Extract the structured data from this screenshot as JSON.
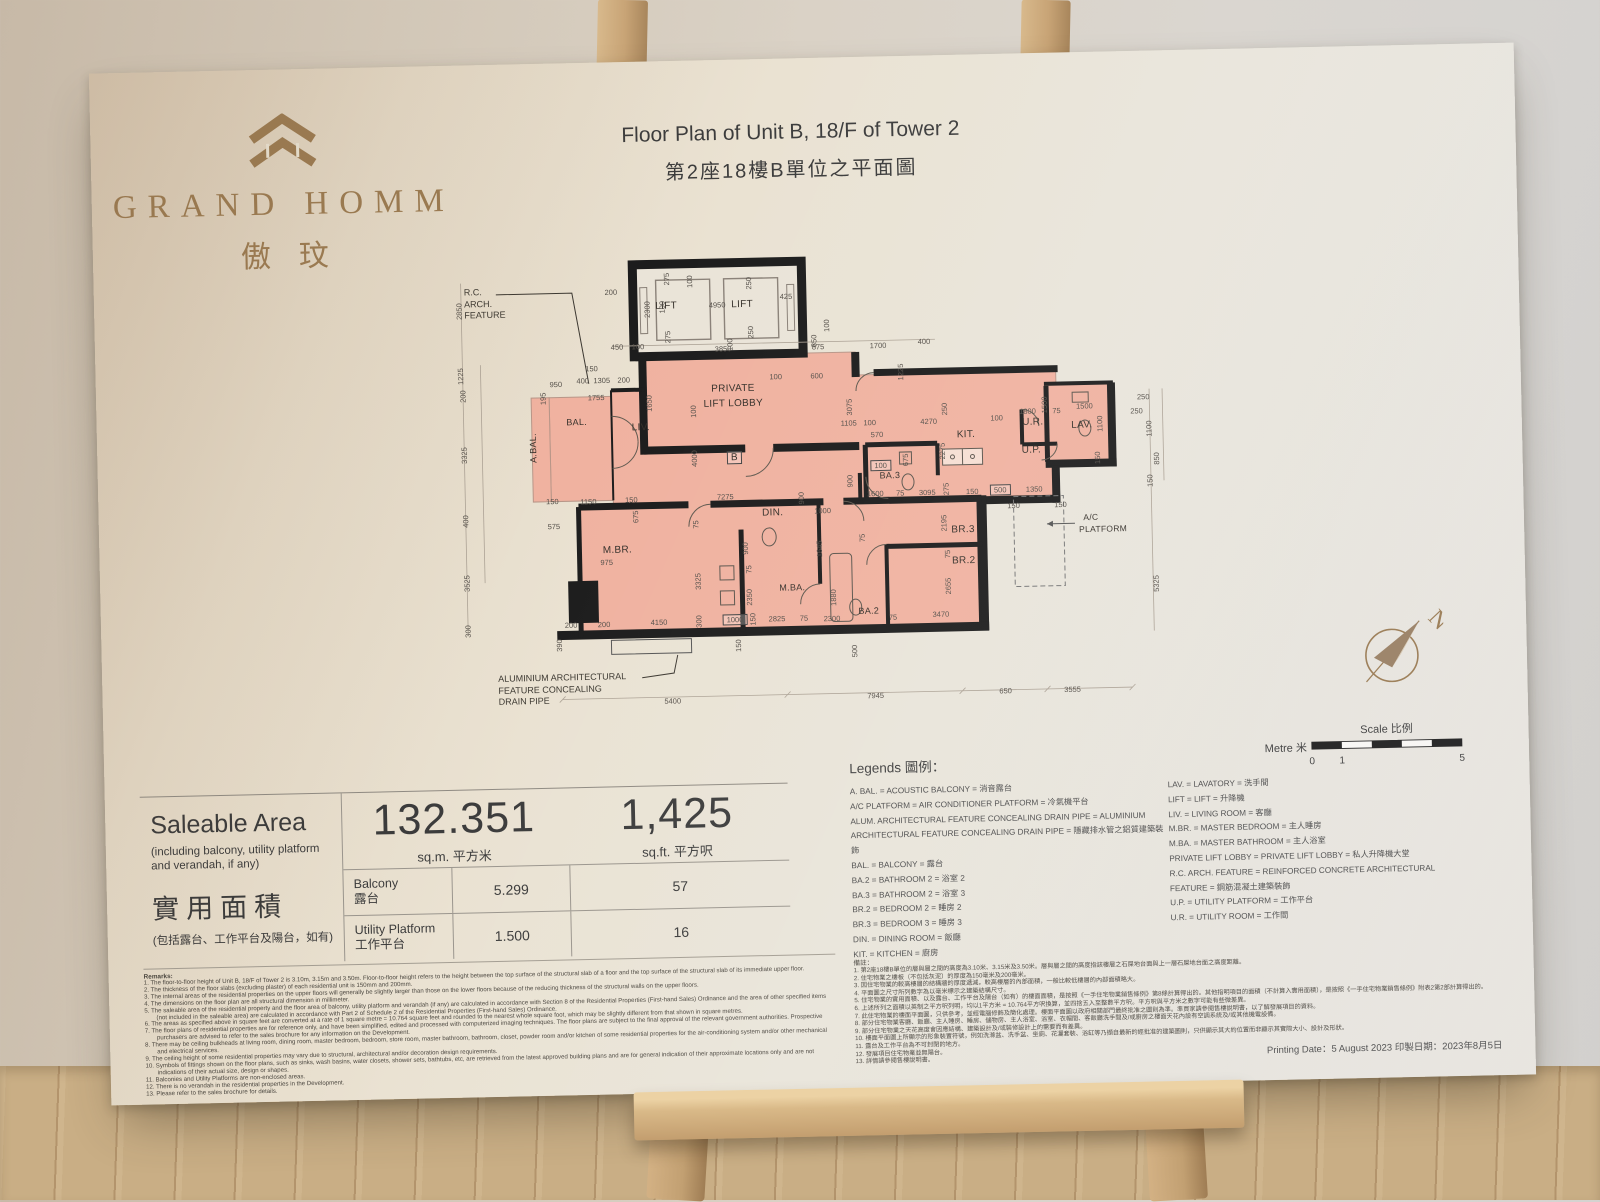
{
  "logo": {
    "name": "GRAND HOMM",
    "chinese": "傲玟",
    "brand_color": "#9b7b52"
  },
  "title": {
    "en": "Floor Plan of Unit B, 18/F of Tower 2",
    "zh": "第2座18樓B單位之平面圖"
  },
  "plan": {
    "fill_color": "#f0b2a0",
    "unit_marker": "B",
    "north_label": "N",
    "rc_feature": [
      "R.C.",
      "ARCH.",
      "FEATURE"
    ],
    "alum_feature": [
      "ALUMINIUM  ARCHITECTURAL",
      "FEATURE  CONCEALING",
      "DRAIN  PIPE"
    ],
    "rooms": [
      {
        "t": "LIFT",
        "x": 232,
        "y": 57
      },
      {
        "t": "LIFT",
        "x": 308,
        "y": 57
      },
      {
        "t": "PRIVATE",
        "x": 297,
        "y": 141
      },
      {
        "t": "LIFT LOBBY",
        "x": 297,
        "y": 156
      },
      {
        "t": "BAL.",
        "x": 140,
        "y": 171,
        "s": 9
      },
      {
        "t": "A.BAL.",
        "x": 96,
        "y": 196,
        "v": 1,
        "s": 9
      },
      {
        "t": "LIV.",
        "x": 204,
        "y": 178
      },
      {
        "t": "B",
        "x": 297,
        "y": 210,
        "box": 1
      },
      {
        "t": "DIN.",
        "x": 334,
        "y": 266
      },
      {
        "t": "KIT.",
        "x": 529,
        "y": 192
      },
      {
        "t": "U.R.",
        "x": 596,
        "y": 181
      },
      {
        "t": "U.P.",
        "x": 594,
        "y": 209
      },
      {
        "t": "LAV.",
        "x": 645,
        "y": 185
      },
      {
        "t": "BA.3",
        "x": 452,
        "y": 231,
        "s": 9
      },
      {
        "t": "M.BR.",
        "x": 178,
        "y": 300
      },
      {
        "t": "M.BA.",
        "x": 352,
        "y": 341,
        "s": 9
      },
      {
        "t": "BA.2",
        "x": 428,
        "y": 366,
        "s": 9
      },
      {
        "t": "BR.3",
        "x": 524,
        "y": 287
      },
      {
        "t": "BR.2",
        "x": 524,
        "y": 318
      },
      {
        "t": "A/C",
        "x": 652,
        "y": 277,
        "s": 8.5
      },
      {
        "t": "PLATFORM",
        "x": 664,
        "y": 289,
        "s": 8.5
      }
    ],
    "dims": [
      {
        "t": "200",
        "x": 177,
        "y": 42
      },
      {
        "t": "2300",
        "x": 213,
        "y": 60,
        "v": 1
      },
      {
        "t": "100",
        "x": 228,
        "y": 58,
        "v": 1
      },
      {
        "t": "4950",
        "x": 283,
        "y": 57
      },
      {
        "t": "425",
        "x": 352,
        "y": 50
      },
      {
        "t": "275",
        "x": 233,
        "y": 30,
        "v": 1
      },
      {
        "t": "100",
        "x": 256,
        "y": 33,
        "v": 1
      },
      {
        "t": "250",
        "x": 315,
        "y": 36,
        "v": 1
      },
      {
        "t": "275",
        "x": 233,
        "y": 88,
        "v": 1
      },
      {
        "t": "250",
        "x": 316,
        "y": 85,
        "v": 1
      },
      {
        "t": "100",
        "x": 295,
        "y": 97,
        "v": 1
      },
      {
        "t": "450",
        "x": 182,
        "y": 97
      },
      {
        "t": "100",
        "x": 203,
        "y": 97
      },
      {
        "t": "3850",
        "x": 288,
        "y": 101
      },
      {
        "t": "875",
        "x": 383,
        "y": 101
      },
      {
        "t": "1700",
        "x": 443,
        "y": 101
      },
      {
        "t": "400",
        "x": 489,
        "y": 98
      },
      {
        "t": "150",
        "x": 156,
        "y": 118
      },
      {
        "t": "950",
        "x": 120,
        "y": 133
      },
      {
        "t": "400",
        "x": 147,
        "y": 130
      },
      {
        "t": "1305",
        "x": 166,
        "y": 130
      },
      {
        "t": "200",
        "x": 188,
        "y": 130
      },
      {
        "t": "1650",
        "x": 213,
        "y": 154,
        "v": 1
      },
      {
        "t": "1755",
        "x": 160,
        "y": 147
      },
      {
        "t": "100",
        "x": 257,
        "y": 163,
        "v": 1
      },
      {
        "t": "850",
        "x": 379,
        "y": 95,
        "v": 1
      },
      {
        "t": "100",
        "x": 392,
        "y": 80,
        "v": 1
      },
      {
        "t": "1225",
        "x": 465,
        "y": 128,
        "v": 1
      },
      {
        "t": "100",
        "x": 340,
        "y": 130
      },
      {
        "t": "600",
        "x": 381,
        "y": 130
      },
      {
        "t": "3075",
        "x": 413,
        "y": 162,
        "v": 1
      },
      {
        "t": "1105",
        "x": 412,
        "y": 178
      },
      {
        "t": "100",
        "x": 433,
        "y": 178
      },
      {
        "t": "570",
        "x": 440,
        "y": 190
      },
      {
        "t": "4270",
        "x": 492,
        "y": 178
      },
      {
        "t": "250",
        "x": 508,
        "y": 166,
        "v": 1
      },
      {
        "t": "2275",
        "x": 505,
        "y": 208,
        "v": 1
      },
      {
        "t": "675",
        "x": 468,
        "y": 216,
        "v": 1
      },
      {
        "t": "100",
        "x": 560,
        "y": 176
      },
      {
        "t": "1800",
        "x": 591,
        "y": 170
      },
      {
        "t": "1500",
        "x": 608,
        "y": 164,
        "v": 1
      },
      {
        "t": "75",
        "x": 620,
        "y": 170
      },
      {
        "t": "1500",
        "x": 648,
        "y": 166
      },
      {
        "t": "1100",
        "x": 663,
        "y": 184,
        "v": 1
      },
      {
        "t": "250",
        "x": 700,
        "y": 172
      },
      {
        "t": "1100",
        "x": 712,
        "y": 190,
        "v": 1
      },
      {
        "t": "150",
        "x": 660,
        "y": 218,
        "v": 1
      },
      {
        "t": "850",
        "x": 719,
        "y": 220,
        "v": 1
      },
      {
        "t": "150",
        "x": 712,
        "y": 242,
        "v": 1
      },
      {
        "t": "5325",
        "x": 716,
        "y": 345,
        "v": 1
      },
      {
        "t": "100",
        "x": 443,
        "y": 221,
        "box": 1
      },
      {
        "t": "900",
        "x": 412,
        "y": 236,
        "v": 1
      },
      {
        "t": "1600",
        "x": 437,
        "y": 249
      },
      {
        "t": "75",
        "x": 462,
        "y": 249
      },
      {
        "t": "3095",
        "x": 489,
        "y": 249
      },
      {
        "t": "275",
        "x": 508,
        "y": 246,
        "v": 1
      },
      {
        "t": "150",
        "x": 534,
        "y": 249
      },
      {
        "t": "500",
        "x": 562,
        "y": 248,
        "box": 1
      },
      {
        "t": "1350",
        "x": 596,
        "y": 248
      },
      {
        "t": "150",
        "x": 575,
        "y": 264
      },
      {
        "t": "150",
        "x": 622,
        "y": 264
      },
      {
        "t": "7275",
        "x": 287,
        "y": 249
      },
      {
        "t": "75",
        "x": 257,
        "y": 276,
        "v": 1
      },
      {
        "t": "4000",
        "x": 257,
        "y": 210,
        "v": 1
      },
      {
        "t": "1000",
        "x": 384,
        "y": 265
      },
      {
        "t": "900",
        "x": 363,
        "y": 252,
        "v": 1
      },
      {
        "t": "1645",
        "x": 380,
        "y": 303,
        "v": 1
      },
      {
        "t": "75",
        "x": 423,
        "y": 293,
        "v": 1
      },
      {
        "t": "2195",
        "x": 505,
        "y": 280,
        "v": 1
      },
      {
        "t": "975",
        "x": 167,
        "y": 312
      },
      {
        "t": "3325",
        "x": 258,
        "y": 333,
        "v": 1
      },
      {
        "t": "900",
        "x": 306,
        "y": 301,
        "v": 1
      },
      {
        "t": "75",
        "x": 309,
        "y": 322,
        "v": 1
      },
      {
        "t": "2350",
        "x": 309,
        "y": 350,
        "v": 1
      },
      {
        "t": "1880",
        "x": 393,
        "y": 352,
        "v": 1
      },
      {
        "t": "2300",
        "x": 391,
        "y": 373
      },
      {
        "t": "75",
        "x": 452,
        "y": 373
      },
      {
        "t": "3470",
        "x": 500,
        "y": 371
      },
      {
        "t": "2655",
        "x": 508,
        "y": 343,
        "v": 1
      },
      {
        "t": "75",
        "x": 508,
        "y": 311,
        "v": 1
      },
      {
        "t": "200",
        "x": 130,
        "y": 374
      },
      {
        "t": "200",
        "x": 163,
        "y": 374
      },
      {
        "t": "4150",
        "x": 218,
        "y": 373
      },
      {
        "t": "300",
        "x": 258,
        "y": 373,
        "v": 1
      },
      {
        "t": "1000",
        "x": 294,
        "y": 372,
        "box": 1
      },
      {
        "t": "150",
        "x": 312,
        "y": 372,
        "v": 1
      },
      {
        "t": "2825",
        "x": 336,
        "y": 372
      },
      {
        "t": "75",
        "x": 363,
        "y": 372
      },
      {
        "t": "390",
        "x": 118,
        "y": 394,
        "v": 1
      },
      {
        "t": "150",
        "x": 297,
        "y": 398,
        "v": 1
      },
      {
        "t": "500",
        "x": 413,
        "y": 406,
        "v": 1
      },
      {
        "t": "2850",
        "x": 25,
        "y": 58,
        "v": 1
      },
      {
        "t": "1225",
        "x": 25,
        "y": 123,
        "v": 1
      },
      {
        "t": "200",
        "x": 27,
        "y": 143,
        "v": 1
      },
      {
        "t": "3325",
        "x": 27,
        "y": 202,
        "v": 1
      },
      {
        "t": "400",
        "x": 27,
        "y": 268,
        "v": 1
      },
      {
        "t": "3525",
        "x": 27,
        "y": 330,
        "v": 1
      },
      {
        "t": "300",
        "x": 27,
        "y": 378,
        "v": 1
      },
      {
        "t": "195",
        "x": 107,
        "y": 147,
        "v": 1
      },
      {
        "t": "150",
        "x": 114,
        "y": 250
      },
      {
        "t": "1150",
        "x": 150,
        "y": 251
      },
      {
        "t": "150",
        "x": 193,
        "y": 250
      },
      {
        "t": "575",
        "x": 115,
        "y": 275
      },
      {
        "t": "675",
        "x": 197,
        "y": 267,
        "v": 1
      },
      {
        "t": "250",
        "x": 707,
        "y": 158
      },
      {
        "t": "5400",
        "x": 230,
        "y": 452
      },
      {
        "t": "7945",
        "x": 433,
        "y": 451
      },
      {
        "t": "650",
        "x": 563,
        "y": 449
      },
      {
        "t": "3555",
        "x": 630,
        "y": 449
      }
    ]
  },
  "scale_bar": {
    "title": "Scale 比例",
    "unit": "Metre 米",
    "ticks": [
      "0",
      "1",
      "5"
    ]
  },
  "area_panel": {
    "heading_en": "Saleable Area",
    "sub_en": "(including balcony, utility platform and verandah, if any)",
    "heading_zh": "實用面積",
    "sub_zh": "(包括露台、工作平台及陽台，如有)",
    "sqm_value": "132.351",
    "sqm_unit": "sq.m. 平方米",
    "sqft_value": "1,425",
    "sqft_unit": "sq.ft. 平方呎",
    "rows": [
      {
        "label_en": "Balcony",
        "label_zh": "露台",
        "sqm": "5.299",
        "sqft": "57"
      },
      {
        "label_en": "Utility Platform",
        "label_zh": "工作平台",
        "sqm": "1.500",
        "sqft": "16"
      }
    ]
  },
  "legends": {
    "title": "Legends 圖例：",
    "left": [
      "A. BAL. = ACOUSTIC BALCONY = 消音露台",
      "A/C PLATFORM = AIR CONDITIONER PLATFORM = 冷氣機平台",
      "ALUM. ARCHITECTURAL FEATURE CONCEALING DRAIN PIPE = ALUMINIUM",
      "ARCHITECTURAL FEATURE CONCEALING DRAIN PIPE = 隱藏排水管之鋁質建築裝飾",
      "BAL. = BALCONY = 露台",
      "BA.2 = BATHROOM 2 = 浴室 2",
      "BA.3 = BATHROOM 2 = 浴室 3",
      "BR.2 = BEDROOM 2 = 睡房 2",
      "BR.3 = BEDROOM 3 = 睡房 3",
      "DIN. = DINING ROOM = 飯廳",
      "KIT. = KITCHEN = 廚房"
    ],
    "right": [
      "LAV. = LAVATORY = 洗手間",
      "LIFT = LIFT = 升降機",
      "LIV. = LIVING ROOM = 客廳",
      "M.BR. = MASTER BEDROOM = 主人睡房",
      "M.BA. = MASTER BATHROOM = 主人浴室",
      "PRIVATE LIFT LOBBY = PRIVATE LIFT LOBBY = 私人升降機大堂",
      "R.C. ARCH. FEATURE = REINFORCED CONCRETE ARCHITECTURAL FEATURE = 鋼筋混凝土建築裝飾",
      "U.P. = UTILITY PLATFORM = 工作平台",
      "U.R. = UTILITY ROOM = 工作間"
    ]
  },
  "remarks_en": {
    "title": "Remarks:",
    "items": [
      "1. The floor-to-floor height of Unit B, 18/F of Tower 2 is 3.10m, 3.15m and 3.50m. Floor-to-floor height refers to the height between the top surface of the structural slab of a floor and the top surface of the structural slab of its immediate upper floor.",
      "2. The thickness of the floor slabs (excluding plaster) of each residential unit is 150mm and 200mm.",
      "3. The internal areas of the residential properties on the upper floors will generally be slightly larger than those on the lower floors because of the reducing thickness of the structural walls on the upper floors.",
      "4. The dimensions on the floor plan are all structural dimension in millimeter.",
      "5. The saleable area of the residential property and the floor area of balcony, utility platform and verandah (if any) are calculated in accordance with Section 8 of the Residential Properties (First-hand Sales) Ordinance and the area of other specified items (not included in the saleable area) are calculated in accordance with Part 2 of Schedule 2 of the Residential Properties (First-hand Sales) Ordinance.",
      "6. The areas as specified above in square feet are converted at a rate of 1 square metre = 10.764 square feet and rounded to the nearest whole square foot, which may be slightly different from that shown in square metres.",
      "7. The floor plans of residential properties are for reference only, and have been simplified, edited and processed with computerized imaging techniques. The floor plans are subject to the final approval of the relevant government authorities. Prospective purchasers are advised to refer to the sales brochure for any information on the Development.",
      "8. There may be ceiling bulkheads at living room, dining room, master bedroom, bedroom, store room, master bathroom, bathroom, closet, powder room and/or kitchen of some residential properties for the air-conditioning system and/or other mechanical and electrical services.",
      "9. The ceiling height of some residential properties may vary due to structural, architectural and/or decoration design requirements.",
      "10. Symbols of fittings shown on the floor plans, such as sinks, wash basins, water closets, shower sets, bathtubs, etc, are retrieved from the latest approved building plans and are for general indication of their approximate locations only and are not indications of their actual size, design or shapes.",
      "11. Balconies and Utility Platforms are non-enclosed areas.",
      "12. There is no verandah in the residential properties in the Development.",
      "13. Please refer to the sales brochure for details."
    ]
  },
  "remarks_zh": {
    "title": "備註：",
    "items": [
      "1. 第2座18樓B單位的層與層之間的高度為3.10米、3.15米及3.50米。層與層之間的高度指該樓層之石屎地台面與上一層石屎地台面之高度距離。",
      "2. 住宅物業之樓板（不包括灰泥）的厚度為150毫米及200毫米。",
      "3. 因住宅物業的較高樓層的結構牆的厚度遞減，較高樓層的內部面積，一般比較低樓層的內部面積略大。",
      "4. 平面圖之尺寸所列數字為以毫米標示之建築結構尺寸。",
      "5. 住宅物業的實用面積、以及露台、工作平台及陽台（如有）的樓面面積，是按照《一手住宅物業銷售條例》第8條計算得出的。其他指明項目的面積（不計算入實用面積），是按照《一手住宅物業銷售條例》附表2第2部計算得出的。",
      "6. 上述所列之面積以英制之平方呎列明，均以1平方米 = 10.764平方呎換算，並四捨五入至整數平方呎。平方呎與平方米之數字可能有些微差異。",
      "7. 此住宅物業的樓面平面圖，只供參考，並經電腦修飾及簡化處理。樓面平面圖以政府相關部門最終批准之圖則為準。準買家請參閱售樓說明書，以了解發展項目的資料。",
      "8. 部分住宅物業客廳、飯廳、主人睡房、睡房、儲物房、主人浴室、浴室、衣帽間、客飯廳洗手間及/或廚房之樓面天花內設有空調系統及/或其他機電設備。",
      "9. 部分住宅物業之天花高度會因應結構、建築設計及/或裝修設計上的需要而有差異。",
      "10. 樓面平面圖上所顯示的形象裝置符號，例如洗滌盆、洗手盆、坐廁、花灑套裝、浴缸等乃擷自最新的經批准的建築圖則，只供顯示其大約位置而非顯示其實際大小、設計及形狀。",
      "11. 露台及工作平台為不可封閉的地方。",
      "12. 發展項目住宅物業並無陽台。",
      "13. 詳情請參閱售樓說明書。"
    ]
  },
  "printing_date": "Printing Date：5 August 2023 印製日期：2023年8月5日"
}
